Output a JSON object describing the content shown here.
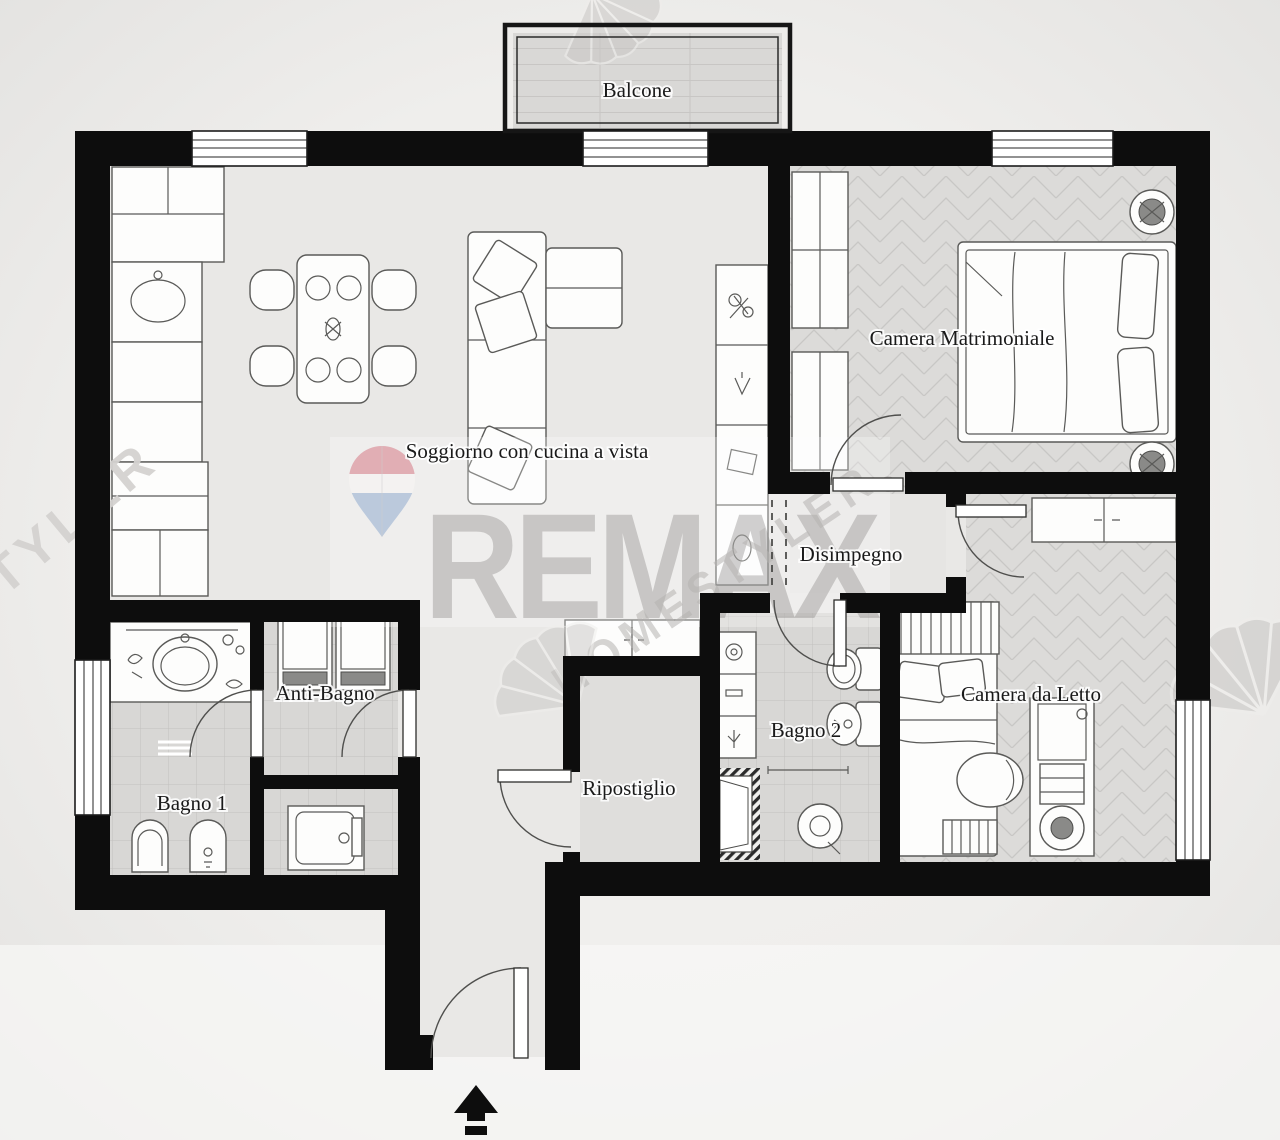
{
  "plan": {
    "rooms": [
      {
        "id": "balcone",
        "label": "Balcone"
      },
      {
        "id": "soggiorno",
        "label": "Soggiorno con cucina a vista"
      },
      {
        "id": "camera-matrimoniale",
        "label": "Camera Matrimoniale"
      },
      {
        "id": "disimpegno",
        "label": "Disimpegno"
      },
      {
        "id": "anti-bagno",
        "label": "Anti-Bagno"
      },
      {
        "id": "bagno-1",
        "label": "Bagno 1"
      },
      {
        "id": "ripostiglio",
        "label": "Ripostiglio"
      },
      {
        "id": "bagno-2",
        "label": "Bagno 2"
      },
      {
        "id": "camera-da-letto",
        "label": "Camera da Letto"
      }
    ],
    "entrance_icon": "up-arrow"
  },
  "watermarks": {
    "brand": "REMAX",
    "registered_mark": "®",
    "diagonal_text": "HOMESTYLER",
    "left_edge_text": "HOMESTYLER",
    "balloon_icon": "remax-balloon-pin",
    "fan_icon": "homestyler-fan"
  },
  "colors": {
    "walls": "#0d0d0d",
    "floor_main": "#e9e8e6",
    "floor_parquet": "#dcdbd9",
    "floor_tile": "#d8d7d5",
    "floor_storage": "#dfdedc",
    "balcony_floor": "#d9d8d6",
    "balloon_top": "#dfa3ab",
    "balloon_mid": "#f5f3f2",
    "balloon_bottom": "#b3c3da",
    "watermark_gray": "#8f8d8b",
    "label_color": "#1a1a1a"
  }
}
